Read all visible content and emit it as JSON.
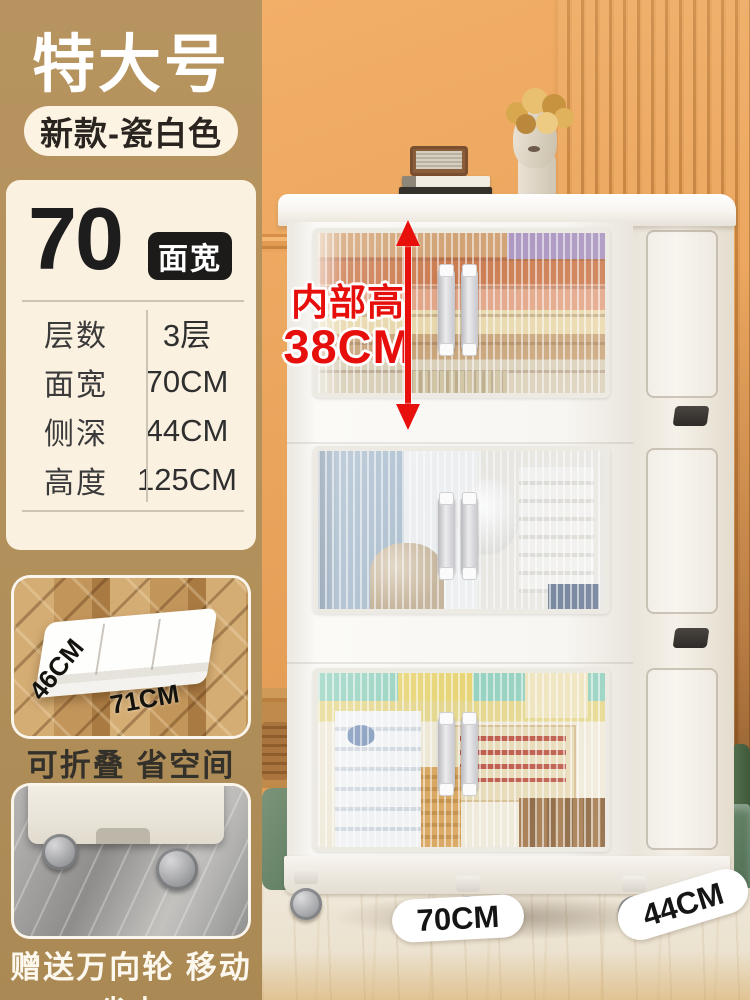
{
  "header": {
    "size_badge": "特大号",
    "variant_pill": "新款-瓷白色"
  },
  "spec_panel": {
    "big_number": "70",
    "big_number_badge": "面宽",
    "rows": [
      {
        "label": "层数",
        "value": "3层"
      },
      {
        "label": "面宽",
        "value": "70CM"
      },
      {
        "label": "侧深",
        "value": "44CM"
      },
      {
        "label": "高度",
        "value": "125CM"
      }
    ]
  },
  "folded_card": {
    "depth_label": "46CM",
    "width_label": "71CM",
    "caption": "可折叠 省空间"
  },
  "wheels_card": {
    "caption": "赠送万向轮 移动省力"
  },
  "annotation": {
    "line1": "内部高",
    "line2": "38CM"
  },
  "floor_labels": {
    "width": "70CM",
    "depth": "44CM"
  },
  "colors": {
    "left_column_tan": "#b2905b",
    "panel_cream": "#fbf1e1",
    "wall_orange": "#eaa45c",
    "accent_red": "#e8100c",
    "badge_black": "#1d1b19",
    "cabinet_white": "#f8f6f2"
  }
}
